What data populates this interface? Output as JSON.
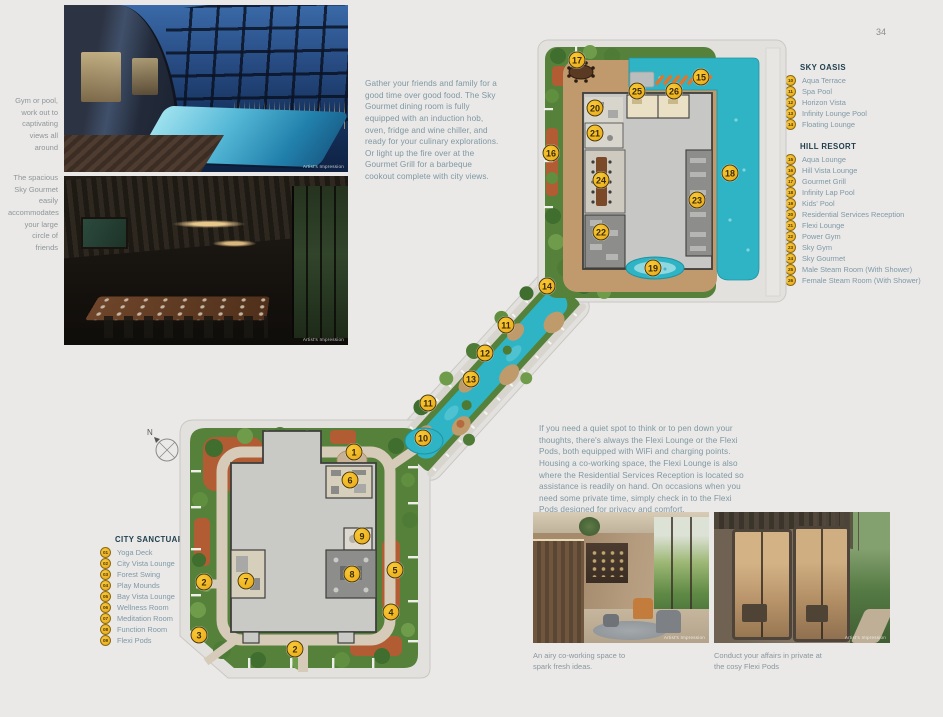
{
  "page": {
    "number": "34"
  },
  "left_column": {
    "caption1": "Gym or pool, work out to captivating views all around",
    "caption2": "The spacious Sky Gourmet easily accommodates your large circle of friends"
  },
  "artist_label": "Artist's Impression",
  "intro_paragraph": "Gather your friends and family for a good time over good food. The Sky Gourmet dining room is fully equipped with an induction hob, oven, fridge and wine chiller, and ready for your culinary explorations. Or light up the fire over at the Gourmet Grill for a barbeque cookout complete with city views.",
  "flexi_paragraph": "If you need a quiet spot to think or to pen down your thoughts, there's always the Flexi Lounge or the Flexi Pods, both equipped with WiFi and charging points. Housing a co-working space, the Flexi Lounge is also where the Residential Services Reception is located so assistance is readily on hand. On occasions when you need some private time, simply check in to the Flexi Pods designed for privacy and comfort.",
  "legends": {
    "sky_oasis": {
      "title": "SKY OASIS",
      "items": [
        {
          "num": "10",
          "label": "Aqua Terrace"
        },
        {
          "num": "11",
          "label": "Spa Pool"
        },
        {
          "num": "12",
          "label": "Horizon Vista"
        },
        {
          "num": "13",
          "label": "Infinity Lounge Pool"
        },
        {
          "num": "14",
          "label": "Floating Lounge"
        }
      ]
    },
    "hill_resort": {
      "title": "HILL RESORT",
      "items": [
        {
          "num": "15",
          "label": "Aqua Lounge"
        },
        {
          "num": "16",
          "label": "Hill Vista Lounge"
        },
        {
          "num": "17",
          "label": "Gourmet Grill"
        },
        {
          "num": "18",
          "label": "Infinity Lap Pool"
        },
        {
          "num": "19",
          "label": "Kids' Pool"
        },
        {
          "num": "20",
          "label": "Residential Services Reception"
        },
        {
          "num": "21",
          "label": "Flexi Lounge"
        },
        {
          "num": "22",
          "label": "Power Gym"
        },
        {
          "num": "23",
          "label": "Sky Gym"
        },
        {
          "num": "24",
          "label": "Sky Gourmet"
        },
        {
          "num": "25",
          "label": "Male Steam Room (With Shower)"
        },
        {
          "num": "26",
          "label": "Female Steam Room (With Shower)"
        }
      ]
    },
    "city_sanctuary": {
      "title": "CITY SANCTUARY",
      "items": [
        {
          "num": "01",
          "label": "Yoga Deck"
        },
        {
          "num": "02",
          "label": "City Vista Lounge"
        },
        {
          "num": "03",
          "label": "Forest Swing"
        },
        {
          "num": "04",
          "label": "Play Mounds"
        },
        {
          "num": "05",
          "label": "Bay Vista Lounge"
        },
        {
          "num": "06",
          "label": "Wellness Room"
        },
        {
          "num": "07",
          "label": "Meditation Room"
        },
        {
          "num": "08",
          "label": "Function Room"
        },
        {
          "num": "09",
          "label": "Flexi Pods"
        }
      ]
    }
  },
  "map_markers": [
    {
      "n": "17",
      "x": 577,
      "y": 60
    },
    {
      "n": "15",
      "x": 701,
      "y": 77
    },
    {
      "n": "25",
      "x": 637,
      "y": 91
    },
    {
      "n": "26",
      "x": 674,
      "y": 91
    },
    {
      "n": "20",
      "x": 595,
      "y": 108
    },
    {
      "n": "21",
      "x": 595,
      "y": 133
    },
    {
      "n": "16",
      "x": 551,
      "y": 153
    },
    {
      "n": "24",
      "x": 601,
      "y": 180
    },
    {
      "n": "18",
      "x": 730,
      "y": 173
    },
    {
      "n": "23",
      "x": 697,
      "y": 200
    },
    {
      "n": "22",
      "x": 601,
      "y": 232
    },
    {
      "n": "19",
      "x": 653,
      "y": 268
    },
    {
      "n": "14",
      "x": 547,
      "y": 286
    },
    {
      "n": "11",
      "x": 506,
      "y": 325
    },
    {
      "n": "12",
      "x": 485,
      "y": 353
    },
    {
      "n": "13",
      "x": 471,
      "y": 379
    },
    {
      "n": "11",
      "x": 428,
      "y": 403
    },
    {
      "n": "10",
      "x": 423,
      "y": 438
    },
    {
      "n": "1",
      "x": 354,
      "y": 452
    },
    {
      "n": "6",
      "x": 350,
      "y": 480
    },
    {
      "n": "9",
      "x": 362,
      "y": 536
    },
    {
      "n": "8",
      "x": 352,
      "y": 574
    },
    {
      "n": "7",
      "x": 246,
      "y": 581
    },
    {
      "n": "2",
      "x": 204,
      "y": 582
    },
    {
      "n": "5",
      "x": 395,
      "y": 570
    },
    {
      "n": "4",
      "x": 391,
      "y": 612
    },
    {
      "n": "3",
      "x": 199,
      "y": 635
    },
    {
      "n": "2",
      "x": 295,
      "y": 649
    }
  ],
  "bottom_photos": {
    "coworking_caption": "An airy co-working space to spark fresh ideas.",
    "flexipods_caption": "Conduct your affairs in private at the cosy Flexi Pods"
  },
  "compass": {
    "label": "N"
  },
  "colors": {
    "badge_yellow": "#f2b722",
    "pool_teal": "#2eb4c5",
    "deck_tan": "#c09a6c",
    "landscape_green": "#55813a",
    "terracotta": "#b15c33",
    "legend_header": "#20404f",
    "legend_text": "#7f99a7"
  }
}
